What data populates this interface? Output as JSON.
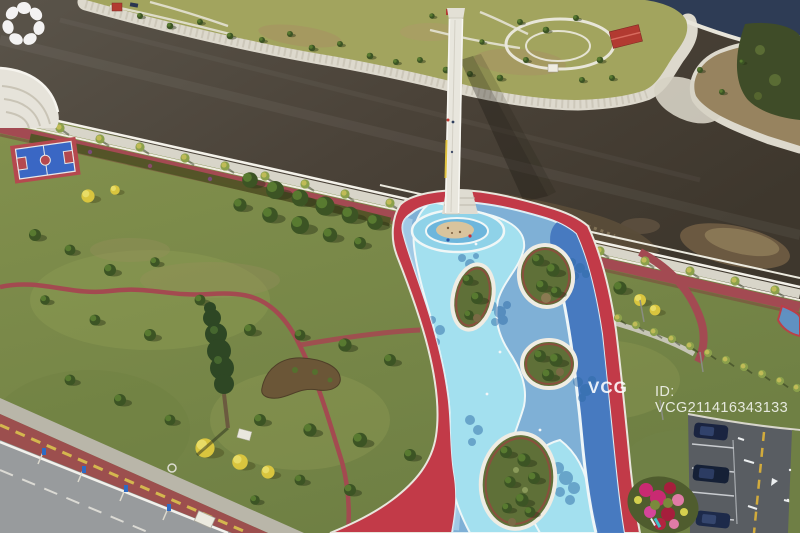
{
  "image": {
    "kind": "aerial-drone-photograph",
    "description": "Aerial view of a riverside park: a winding blue leisure plaza with red borders and oval planting islands, a narrow white footbridge crossing a brown river to a landscaped islet with a red-roofed pavilion, lawns with scattered trees, a basketball court, a waterfront promenade with palms, a coastal road, a parking lot with dark cars and a magenta flower bed."
  },
  "watermark": {
    "brand": "VCG",
    "id_text": "ID: VCG211416343133"
  },
  "palette": {
    "river_water": "#4e463b",
    "sea_water": "#2e3c55",
    "rock_shore": "#ddd9cd",
    "islet_grass": "#a2a45e",
    "park_lawn": "#7d8c4b",
    "tree_green": "#3c5424",
    "plaza_red": "#c23a48",
    "plaza_light_blue": "#7fb0d6",
    "plaza_cyan": "#a3e0ef",
    "plaza_deep_blue": "#4577bf",
    "sand": "#d9c49d",
    "running_track": "#a34a52",
    "road_grey": "#989b9d",
    "parking_asphalt": "#595d62",
    "car_navy": "#1a2440",
    "flower_magenta": "#c92a72",
    "watermark_white": "#ffffff"
  },
  "scene_regions": [
    "river",
    "sea-inlet",
    "islet-garden",
    "footbridge",
    "waterfront-promenade",
    "amphitheater-steps",
    "basketball-court",
    "park-lawn",
    "blue-plaza",
    "planting-islands",
    "coastal-road",
    "parking-lot",
    "flower-bed"
  ]
}
